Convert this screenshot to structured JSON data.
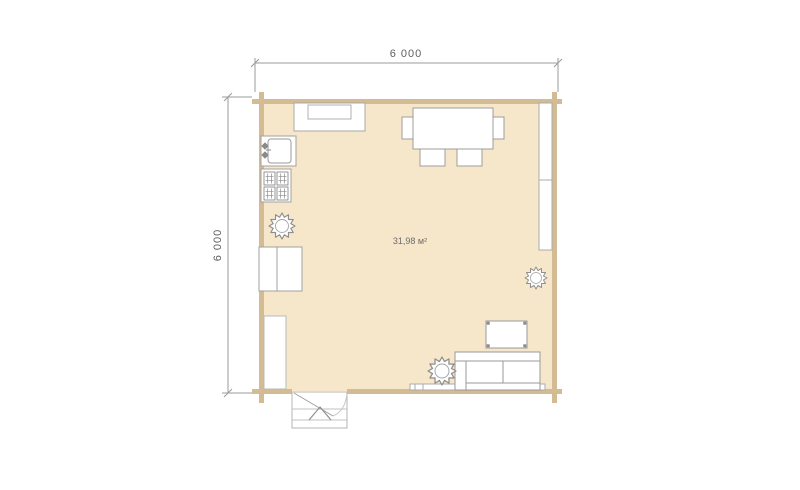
{
  "canvas": {
    "background": "#ffffff"
  },
  "colors": {
    "floor": "#f7e7ca",
    "wall": "#d3bb93",
    "furniture_outline": "#9c9c9c",
    "furniture_fill": "#ffffff",
    "dimension_line": "#9b9b9b",
    "label_text": "#5f5f5f"
  },
  "dimensions": {
    "top": {
      "label": "6 000"
    },
    "left": {
      "label": "6 000"
    }
  },
  "room": {
    "area_label": "31,98 м²"
  },
  "furniture_symbols": [
    "kitchen-counter",
    "kitchen-sink",
    "stove",
    "plant",
    "dining-table",
    "chair",
    "window",
    "glazed-window-band",
    "tall-cabinet",
    "coffee-table",
    "sofa",
    "entrance-door-swing",
    "entrance-porch-steps",
    "entrance-arrow"
  ]
}
